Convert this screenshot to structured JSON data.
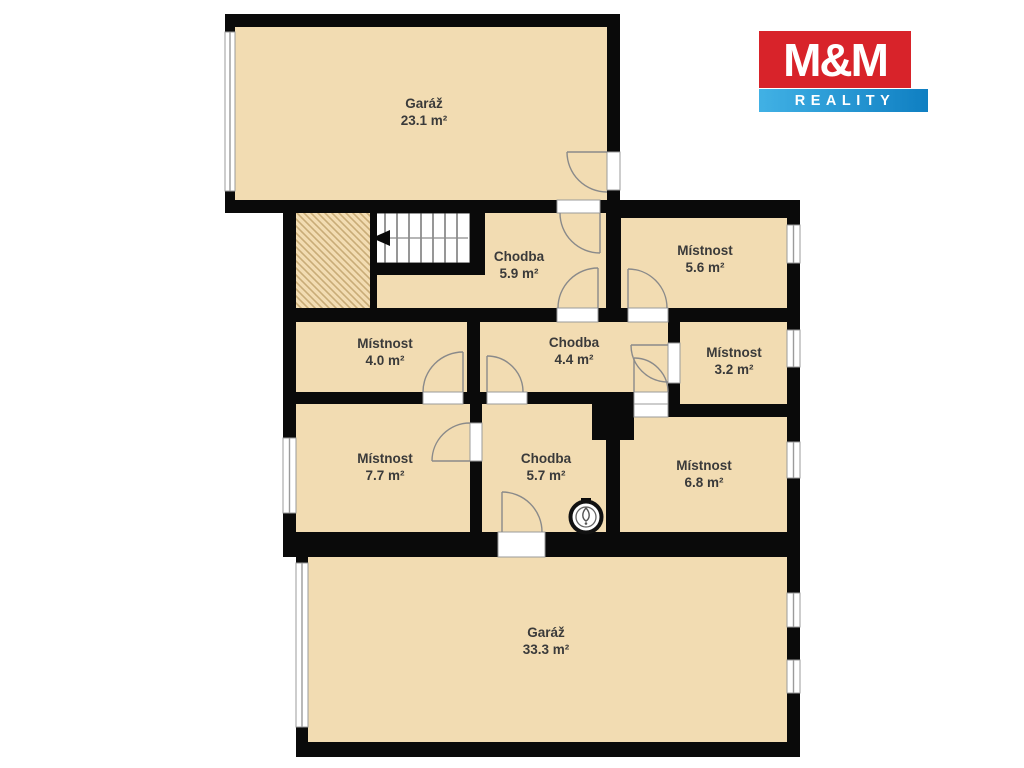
{
  "title": "Floor plan",
  "logo": {
    "brand": "M&M",
    "tagline": "REALITY",
    "red": "#d8232a",
    "blue": "#1286c8"
  },
  "colors": {
    "room_fill": "#f2dcb2",
    "wall": "#0a0a0a",
    "hatch_line": "#c9ac77",
    "door_arc": "#8a8a8a",
    "window_line": "#9b9b9b",
    "label_text": "#3a3a3a"
  },
  "rooms": [
    {
      "name": "Garáž",
      "area": "23.1 m²"
    },
    {
      "name": "Chodba",
      "area": "5.9 m²"
    },
    {
      "name": "Místnost",
      "area": "5.6 m²"
    },
    {
      "name": "Místnost",
      "area": "4.0 m²"
    },
    {
      "name": "Chodba",
      "area": "4.4 m²"
    },
    {
      "name": "Místnost",
      "area": "3.2 m²"
    },
    {
      "name": "Místnost",
      "area": "7.7 m²"
    },
    {
      "name": "Chodba",
      "area": "5.7 m²"
    },
    {
      "name": "Místnost",
      "area": "6.8 m²"
    },
    {
      "name": "Garáž",
      "area": "33.3 m²"
    }
  ],
  "icons": {
    "stairs": "staircase-with-direction-arrow",
    "boiler": "boiler-circle-symbol"
  }
}
